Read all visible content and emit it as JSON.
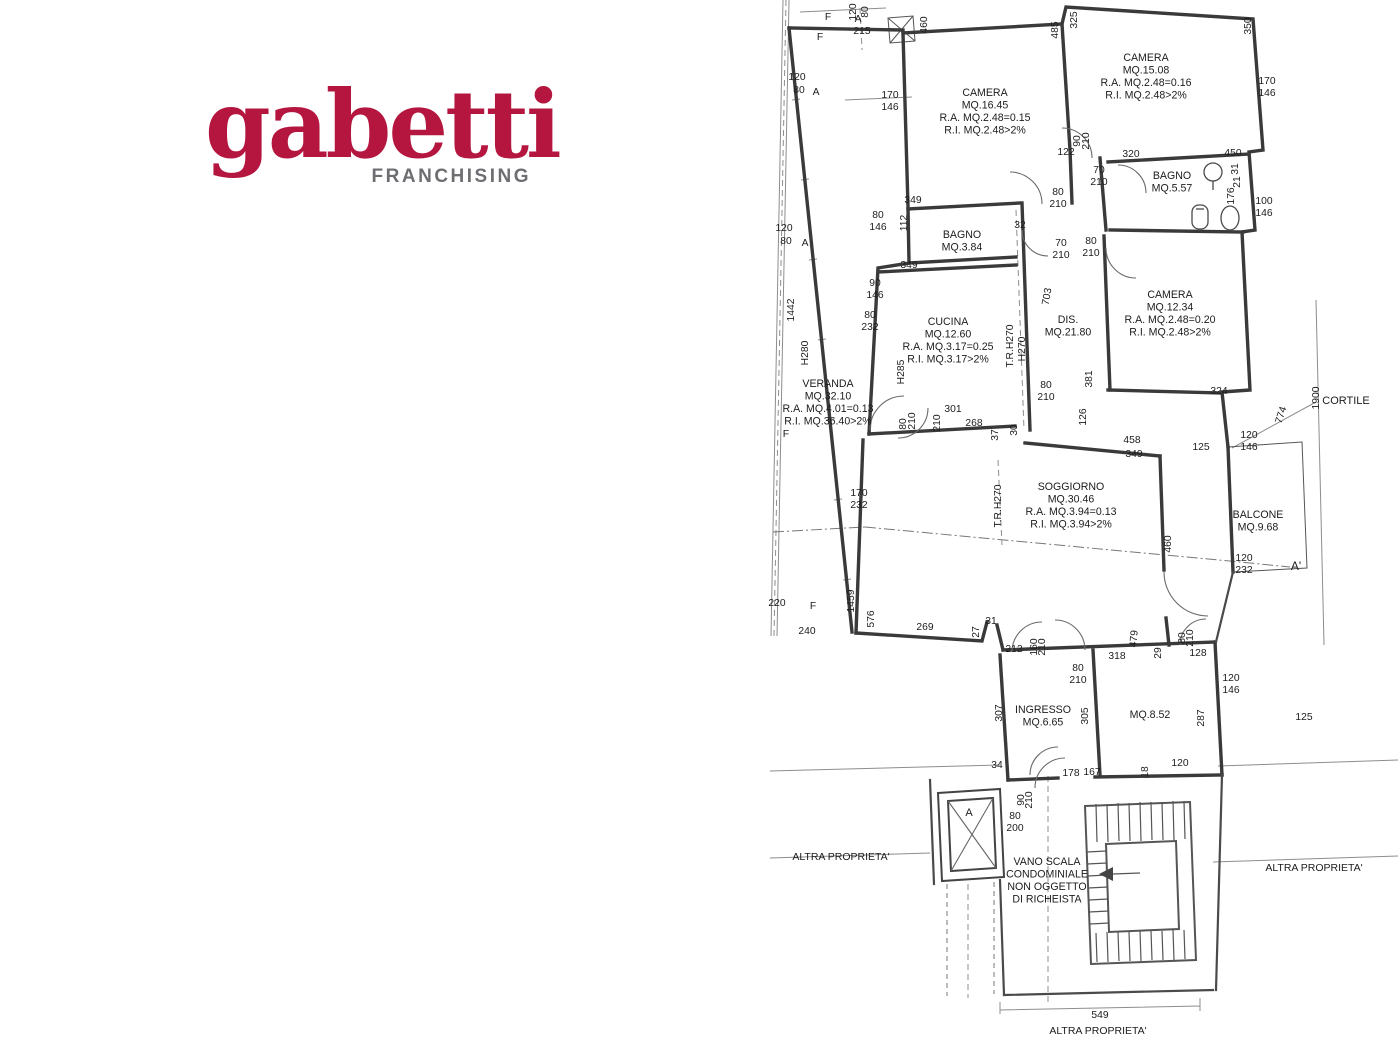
{
  "logo": {
    "brand": "gabetti",
    "subtitle": "FRANCHISING",
    "brand_color": "#b5163f",
    "subtitle_color": "#6d6e71"
  },
  "plan": {
    "rooms": [
      {
        "id": "camera-16",
        "x": 985,
        "y": 96,
        "lines": [
          "CAMERA",
          "MQ.16.45",
          "R.A. MQ.2.48=0.15",
          "R.I. MQ.2.48>2%"
        ]
      },
      {
        "id": "camera-15",
        "x": 1146,
        "y": 61,
        "lines": [
          "CAMERA",
          "MQ.15.08",
          "R.A. MQ.2.48=0.16",
          "R.I. MQ.2.48>2%"
        ]
      },
      {
        "id": "bagno-5",
        "x": 1172,
        "y": 179,
        "lines": [
          "BAGNO",
          "MQ.5.57"
        ]
      },
      {
        "id": "bagno-3",
        "x": 962,
        "y": 238,
        "lines": [
          "BAGNO",
          "MQ.3.84"
        ]
      },
      {
        "id": "cucina",
        "x": 948,
        "y": 325,
        "lines": [
          "CUCINA",
          "MQ.12.60",
          "R.A. MQ.3.17=0.25",
          "R.I. MQ.3.17>2%"
        ]
      },
      {
        "id": "dis",
        "x": 1068,
        "y": 323,
        "lines": [
          "DIS.",
          "MQ.21.80"
        ]
      },
      {
        "id": "camera-12",
        "x": 1170,
        "y": 298,
        "lines": [
          "CAMERA",
          "MQ.12.34",
          "R.A. MQ.2.48=0.20",
          "R.I. MQ.2.48>2%"
        ]
      },
      {
        "id": "veranda",
        "x": 828,
        "y": 387,
        "lines": [
          "VERANDA",
          "MQ.32.10",
          "R.A. MQ.4.01=0.13",
          "R.I. MQ.36.40>2%"
        ]
      },
      {
        "id": "soggiorno",
        "x": 1071,
        "y": 490,
        "lines": [
          "SOGGIORNO",
          "MQ.30.46",
          "R.A. MQ.3.94=0.13",
          "R.I. MQ.3.94>2%"
        ]
      },
      {
        "id": "balcone",
        "x": 1258,
        "y": 518,
        "lines": [
          "BALCONE",
          "MQ.9.68"
        ]
      },
      {
        "id": "ingresso",
        "x": 1043,
        "y": 713,
        "lines": [
          "INGRESSO",
          "MQ.6.65"
        ]
      },
      {
        "id": "room-852",
        "x": 1150,
        "y": 718,
        "lines": [
          "MQ.8.52"
        ]
      },
      {
        "id": "vano-scala",
        "x": 1047,
        "y": 865,
        "lines": [
          "VANO SCALA",
          "CONDOMINIALE",
          "NON OGGETTO",
          "DI RICHEISTA"
        ]
      }
    ],
    "dims": [
      {
        "t": "120",
        "x": 856,
        "y": 12,
        "r": -90
      },
      {
        "t": "80",
        "x": 868,
        "y": 12,
        "r": -90
      },
      {
        "t": "A",
        "x": 858,
        "y": 22
      },
      {
        "t": "215",
        "x": 862,
        "y": 34
      },
      {
        "t": "F",
        "x": 828,
        "y": 20
      },
      {
        "t": "F",
        "x": 820,
        "y": 40
      },
      {
        "t": "460",
        "x": 927,
        "y": 25,
        "r": -90
      },
      {
        "t": "485",
        "x": 1058,
        "y": 30,
        "r": -90
      },
      {
        "t": "325",
        "x": 1077,
        "y": 20,
        "r": -90
      },
      {
        "t": "350",
        "x": 1251,
        "y": 26,
        "r": -90
      },
      {
        "t": "120",
        "x": 797,
        "y": 80
      },
      {
        "t": "80",
        "x": 799,
        "y": 93
      },
      {
        "t": "A",
        "x": 816,
        "y": 95
      },
      {
        "t": "170",
        "x": 890,
        "y": 98
      },
      {
        "t": "146",
        "x": 890,
        "y": 110
      },
      {
        "t": "120",
        "x": 784,
        "y": 231
      },
      {
        "t": "80",
        "x": 786,
        "y": 244
      },
      {
        "t": "A",
        "x": 805,
        "y": 246
      },
      {
        "t": "1442",
        "x": 794,
        "y": 310,
        "r": -90
      },
      {
        "t": "H280",
        "x": 808,
        "y": 353,
        "r": -90
      },
      {
        "t": "122",
        "x": 1066,
        "y": 155
      },
      {
        "t": "90",
        "x": 1080,
        "y": 141,
        "r": -90
      },
      {
        "t": "210",
        "x": 1089,
        "y": 141,
        "r": -90
      },
      {
        "t": "320",
        "x": 1131,
        "y": 157
      },
      {
        "t": "450",
        "x": 1233,
        "y": 156
      },
      {
        "t": "70",
        "x": 1099,
        "y": 173
      },
      {
        "t": "210",
        "x": 1099,
        "y": 185
      },
      {
        "t": "170",
        "x": 1267,
        "y": 84
      },
      {
        "t": "146",
        "x": 1267,
        "y": 96
      },
      {
        "t": "31",
        "x": 1238,
        "y": 169,
        "r": -90
      },
      {
        "t": "21",
        "x": 1240,
        "y": 182,
        "r": -90
      },
      {
        "t": "176",
        "x": 1234,
        "y": 196,
        "r": -90
      },
      {
        "t": "100",
        "x": 1264,
        "y": 204
      },
      {
        "t": "146",
        "x": 1264,
        "y": 216
      },
      {
        "t": "80",
        "x": 1058,
        "y": 195
      },
      {
        "t": "210",
        "x": 1058,
        "y": 207
      },
      {
        "t": "349",
        "x": 913,
        "y": 203
      },
      {
        "t": "112",
        "x": 907,
        "y": 223,
        "r": -90
      },
      {
        "t": "80",
        "x": 878,
        "y": 218
      },
      {
        "t": "146",
        "x": 878,
        "y": 230
      },
      {
        "t": "32",
        "x": 1020,
        "y": 228
      },
      {
        "t": "70",
        "x": 1061,
        "y": 246
      },
      {
        "t": "210",
        "x": 1061,
        "y": 258
      },
      {
        "t": "80",
        "x": 1091,
        "y": 244
      },
      {
        "t": "210",
        "x": 1091,
        "y": 256
      },
      {
        "t": "349",
        "x": 909,
        "y": 268
      },
      {
        "t": "90",
        "x": 875,
        "y": 286
      },
      {
        "t": "146",
        "x": 875,
        "y": 298
      },
      {
        "t": "80",
        "x": 870,
        "y": 318
      },
      {
        "t": "232",
        "x": 870,
        "y": 330
      },
      {
        "t": "H285",
        "x": 904,
        "y": 372,
        "r": -90
      },
      {
        "t": "703",
        "x": 1050,
        "y": 297,
        "r": -80
      },
      {
        "t": "381",
        "x": 1092,
        "y": 379,
        "r": -90
      },
      {
        "t": "T.R.H270",
        "x": 1013,
        "y": 346,
        "r": -90
      },
      {
        "t": "H270",
        "x": 1025,
        "y": 349,
        "r": -90
      },
      {
        "t": "80",
        "x": 906,
        "y": 424,
        "r": -90
      },
      {
        "t": "210",
        "x": 915,
        "y": 421,
        "r": -90
      },
      {
        "t": "210",
        "x": 940,
        "y": 423,
        "r": -90
      },
      {
        "t": "301",
        "x": 953,
        "y": 412
      },
      {
        "t": "268",
        "x": 974,
        "y": 426
      },
      {
        "t": "37",
        "x": 998,
        "y": 435,
        "r": -90
      },
      {
        "t": "30",
        "x": 1017,
        "y": 430,
        "r": -90
      },
      {
        "t": "80",
        "x": 1046,
        "y": 388
      },
      {
        "t": "210",
        "x": 1046,
        "y": 400
      },
      {
        "t": "126",
        "x": 1086,
        "y": 417,
        "r": -90
      },
      {
        "t": "458",
        "x": 1132,
        "y": 443
      },
      {
        "t": "349",
        "x": 1134,
        "y": 457
      },
      {
        "t": "324",
        "x": 1219,
        "y": 394
      },
      {
        "t": "125",
        "x": 1201,
        "y": 450
      },
      {
        "t": "120",
        "x": 1249,
        "y": 438
      },
      {
        "t": "146",
        "x": 1249,
        "y": 450
      },
      {
        "t": "774",
        "x": 1284,
        "y": 416,
        "r": -72
      },
      {
        "t": "1900",
        "x": 1319,
        "y": 398,
        "r": -90
      },
      {
        "t": "170",
        "x": 859,
        "y": 496
      },
      {
        "t": "232",
        "x": 859,
        "y": 508
      },
      {
        "t": "T.R.H270",
        "x": 1001,
        "y": 506,
        "r": -90
      },
      {
        "t": "460",
        "x": 1171,
        "y": 544,
        "r": -90
      },
      {
        "t": "120",
        "x": 1244,
        "y": 561
      },
      {
        "t": "232",
        "x": 1244,
        "y": 573
      },
      {
        "t": "A'",
        "x": 1296,
        "y": 570,
        "s": 12
      },
      {
        "t": "220",
        "x": 777,
        "y": 606
      },
      {
        "t": "F",
        "x": 813,
        "y": 609
      },
      {
        "t": "240",
        "x": 807,
        "y": 634
      },
      {
        "t": "1459",
        "x": 854,
        "y": 601,
        "r": -90
      },
      {
        "t": "576",
        "x": 874,
        "y": 619,
        "r": -90
      },
      {
        "t": "269",
        "x": 925,
        "y": 630
      },
      {
        "t": "27",
        "x": 979,
        "y": 632,
        "r": -90
      },
      {
        "t": "31",
        "x": 991,
        "y": 624
      },
      {
        "t": "212",
        "x": 1014,
        "y": 652
      },
      {
        "t": "160",
        "x": 1037,
        "y": 647,
        "r": -90
      },
      {
        "t": "210",
        "x": 1045,
        "y": 647,
        "r": -90
      },
      {
        "t": "318",
        "x": 1117,
        "y": 659
      },
      {
        "t": "479",
        "x": 1137,
        "y": 639,
        "r": -85
      },
      {
        "t": "29",
        "x": 1161,
        "y": 653,
        "r": -90
      },
      {
        "t": "80",
        "x": 1185,
        "y": 638,
        "r": -90
      },
      {
        "t": "210",
        "x": 1193,
        "y": 638,
        "r": -90
      },
      {
        "t": "128",
        "x": 1198,
        "y": 656
      },
      {
        "t": "80",
        "x": 1078,
        "y": 671
      },
      {
        "t": "210",
        "x": 1078,
        "y": 683
      },
      {
        "t": "120",
        "x": 1231,
        "y": 681
      },
      {
        "t": "146",
        "x": 1231,
        "y": 693
      },
      {
        "t": "125",
        "x": 1304,
        "y": 720
      },
      {
        "t": "307",
        "x": 1002,
        "y": 713,
        "r": -90
      },
      {
        "t": "305",
        "x": 1088,
        "y": 716,
        "r": -90
      },
      {
        "t": "287",
        "x": 1204,
        "y": 718,
        "r": -90
      },
      {
        "t": "34",
        "x": 997,
        "y": 768
      },
      {
        "t": "178",
        "x": 1071,
        "y": 776
      },
      {
        "t": "167",
        "x": 1092,
        "y": 775
      },
      {
        "t": "18",
        "x": 1148,
        "y": 772,
        "r": -90
      },
      {
        "t": "120",
        "x": 1180,
        "y": 766
      },
      {
        "t": "90",
        "x": 1024,
        "y": 800,
        "r": -90
      },
      {
        "t": "210",
        "x": 1032,
        "y": 800,
        "r": -90
      },
      {
        "t": "80",
        "x": 1015,
        "y": 819
      },
      {
        "t": "200",
        "x": 1015,
        "y": 831
      },
      {
        "t": "A",
        "x": 969,
        "y": 816,
        "s": 11
      },
      {
        "t": "549",
        "x": 1100,
        "y": 1018
      }
    ],
    "notes": [
      {
        "t": "CORTILE",
        "x": 1346,
        "y": 404,
        "s": 11
      },
      {
        "t": "F",
        "x": 786,
        "y": 437
      },
      {
        "t": "ALTRA PROPRIETA'",
        "x": 841,
        "y": 860
      },
      {
        "t": "ALTRA PROPRIETA'",
        "x": 1314,
        "y": 871
      },
      {
        "t": "ALTRA PROPRIETA'",
        "x": 1098,
        "y": 1034
      }
    ]
  }
}
